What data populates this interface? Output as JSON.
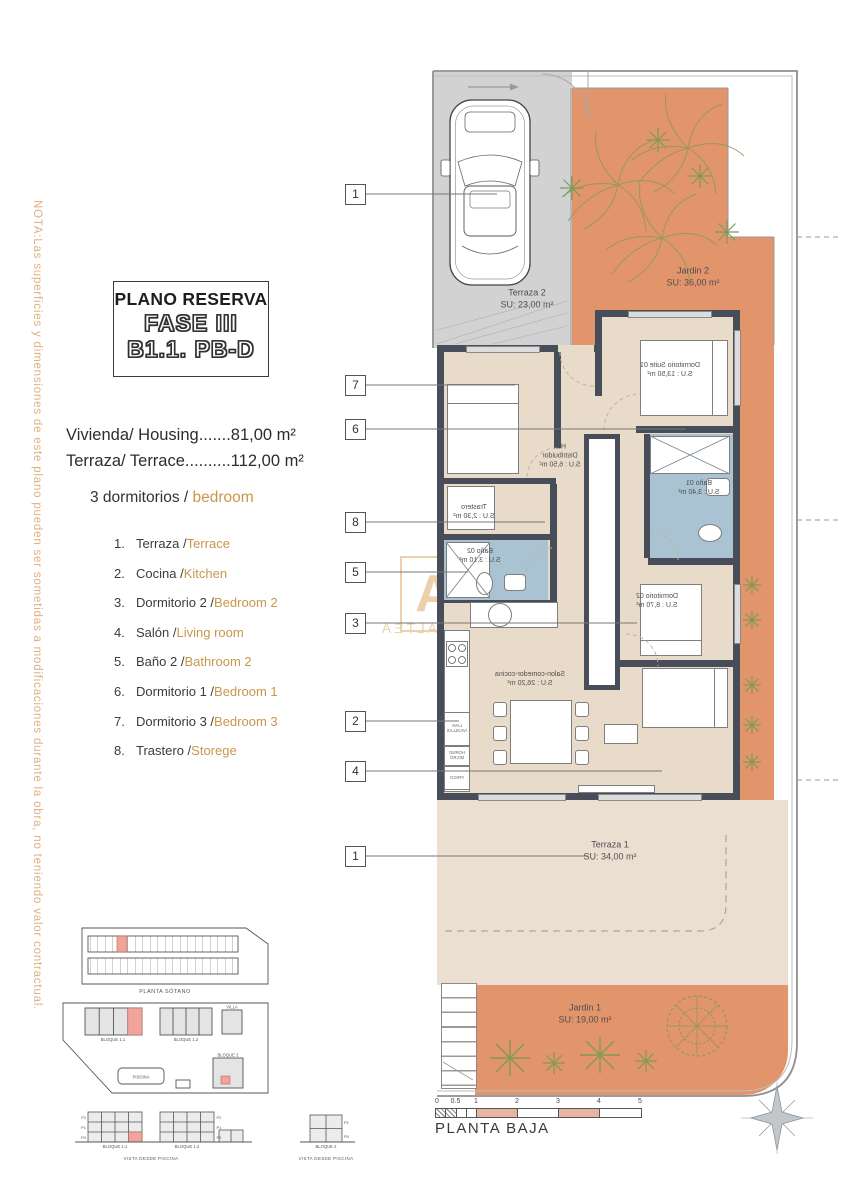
{
  "colors": {
    "accent_orange": "#c9964a",
    "nota_orange": "#e0b083",
    "garden_orange": "#e2946b",
    "wall_dark": "#474e5a",
    "bath_blue": "#a9c3d2",
    "interior_beige": "#e9dbc9",
    "terrace_beige": "#ebdfd2",
    "driveway_gray": "#d2d2d2",
    "highlight_pink": "#f2a49a",
    "scale_pink": "#e9b5a3"
  },
  "nota": {
    "text": "NOTA:Las superficies y dimensiones de este plano pueden ser sometidas a modificaciones durante la obra, no teniendo valor contractual."
  },
  "title_box": {
    "line1": "PLANO RESERVA",
    "line2": "FASE III",
    "line3": "B1.1. PB-D"
  },
  "summary": {
    "housing": "Vivienda/ Housing.......81,00 m²",
    "terrace": "Terraza/ Terrace..........112,00 m²"
  },
  "bedrooms_heading": {
    "prefix": "3 dormitorios / ",
    "highlight": "bedroom"
  },
  "legend": {
    "items": [
      {
        "num": "1.",
        "es": "Terraza / ",
        "en": "Terrace"
      },
      {
        "num": "2.",
        "es": "Cocina / ",
        "en": "Kitchen"
      },
      {
        "num": "3.",
        "es": "Dormitorio 2 / ",
        "en": "Bedroom 2"
      },
      {
        "num": "4.",
        "es": "Salón / ",
        "en": "Living room"
      },
      {
        "num": "5.",
        "es": "Baño 2 / ",
        "en": "Bathroom 2"
      },
      {
        "num": "6.",
        "es": "Dormitorio 1 / ",
        "en": "Bedroom 1"
      },
      {
        "num": "7.",
        "es": "Dormitorio 3 / ",
        "en": "Bedroom 3"
      },
      {
        "num": "8.",
        "es": "Trastero / ",
        "en": "Storege"
      }
    ]
  },
  "plan": {
    "terraza2": {
      "name": "Terraza 2",
      "area": "SU: 23,00 m²"
    },
    "jardin2": {
      "name": "Jardin 2",
      "area": "SU: 36,00 m²"
    },
    "suite": {
      "name": "Dormitorio Suite 01",
      "area": "S.U : 13,50 m²"
    },
    "hall": {
      "name": "Hall",
      "name2": "Distribuidor",
      "area": "S.U : 6,50 m²"
    },
    "trastero": {
      "name": "Trastero",
      "area": "S.U : 2,30 m²"
    },
    "bano01": {
      "name": "Baño 01",
      "area": "S.U : 3,40 m²"
    },
    "bano02": {
      "name": "Baño 02",
      "area": "S.U : 3,10 m²"
    },
    "dorm02": {
      "name": "Dormitorio 02",
      "area": "S.U : 8,70 m²"
    },
    "salon": {
      "name": "Salon-comedor-cocina",
      "area": "S.U : 26,20 m²"
    },
    "terraza1": {
      "name": "Terraza 1",
      "area": "SU: 34,00 m²"
    },
    "jardin1": {
      "name": "Jardin 1",
      "area": "SU: 19,00 m²"
    },
    "kitchen_labels": {
      "dishwasher": "LAVA /VAJILLAS",
      "oven": "HORNO MICRO",
      "fridge": "FRIGO"
    }
  },
  "tags": [
    "1",
    "7",
    "6",
    "8",
    "5",
    "3",
    "2",
    "4",
    "1"
  ],
  "scale_bar": {
    "ticks": [
      "0",
      "0.5",
      "1",
      "2",
      "3",
      "4",
      "5"
    ],
    "label": "PLANTA BAJA"
  },
  "watermark": {
    "letter": "A",
    "text": "IMMO ALTEA"
  },
  "site_diagrams": {
    "sotano_caption": "PLANTA SÓTANO",
    "site": {
      "bloque11": "BLOQUE 1.1",
      "bloque12": "BLOQUE 1.2",
      "bloque2": "BLOQUE 2",
      "villa": "VILLA",
      "piscina": "PISCINA"
    },
    "elevation1": {
      "bloque11": "BLOQUE 1.1",
      "bloque12": "BLOQUE 1.2",
      "floors": [
        "P2",
        "P1",
        "P0"
      ],
      "caption": "VISTA DESDE PISCINA"
    },
    "elevation2": {
      "bloque2": "BLOQUE 2",
      "floors": [
        "P1",
        "P0"
      ],
      "caption": "VISTA DESDE PISCINA"
    }
  }
}
